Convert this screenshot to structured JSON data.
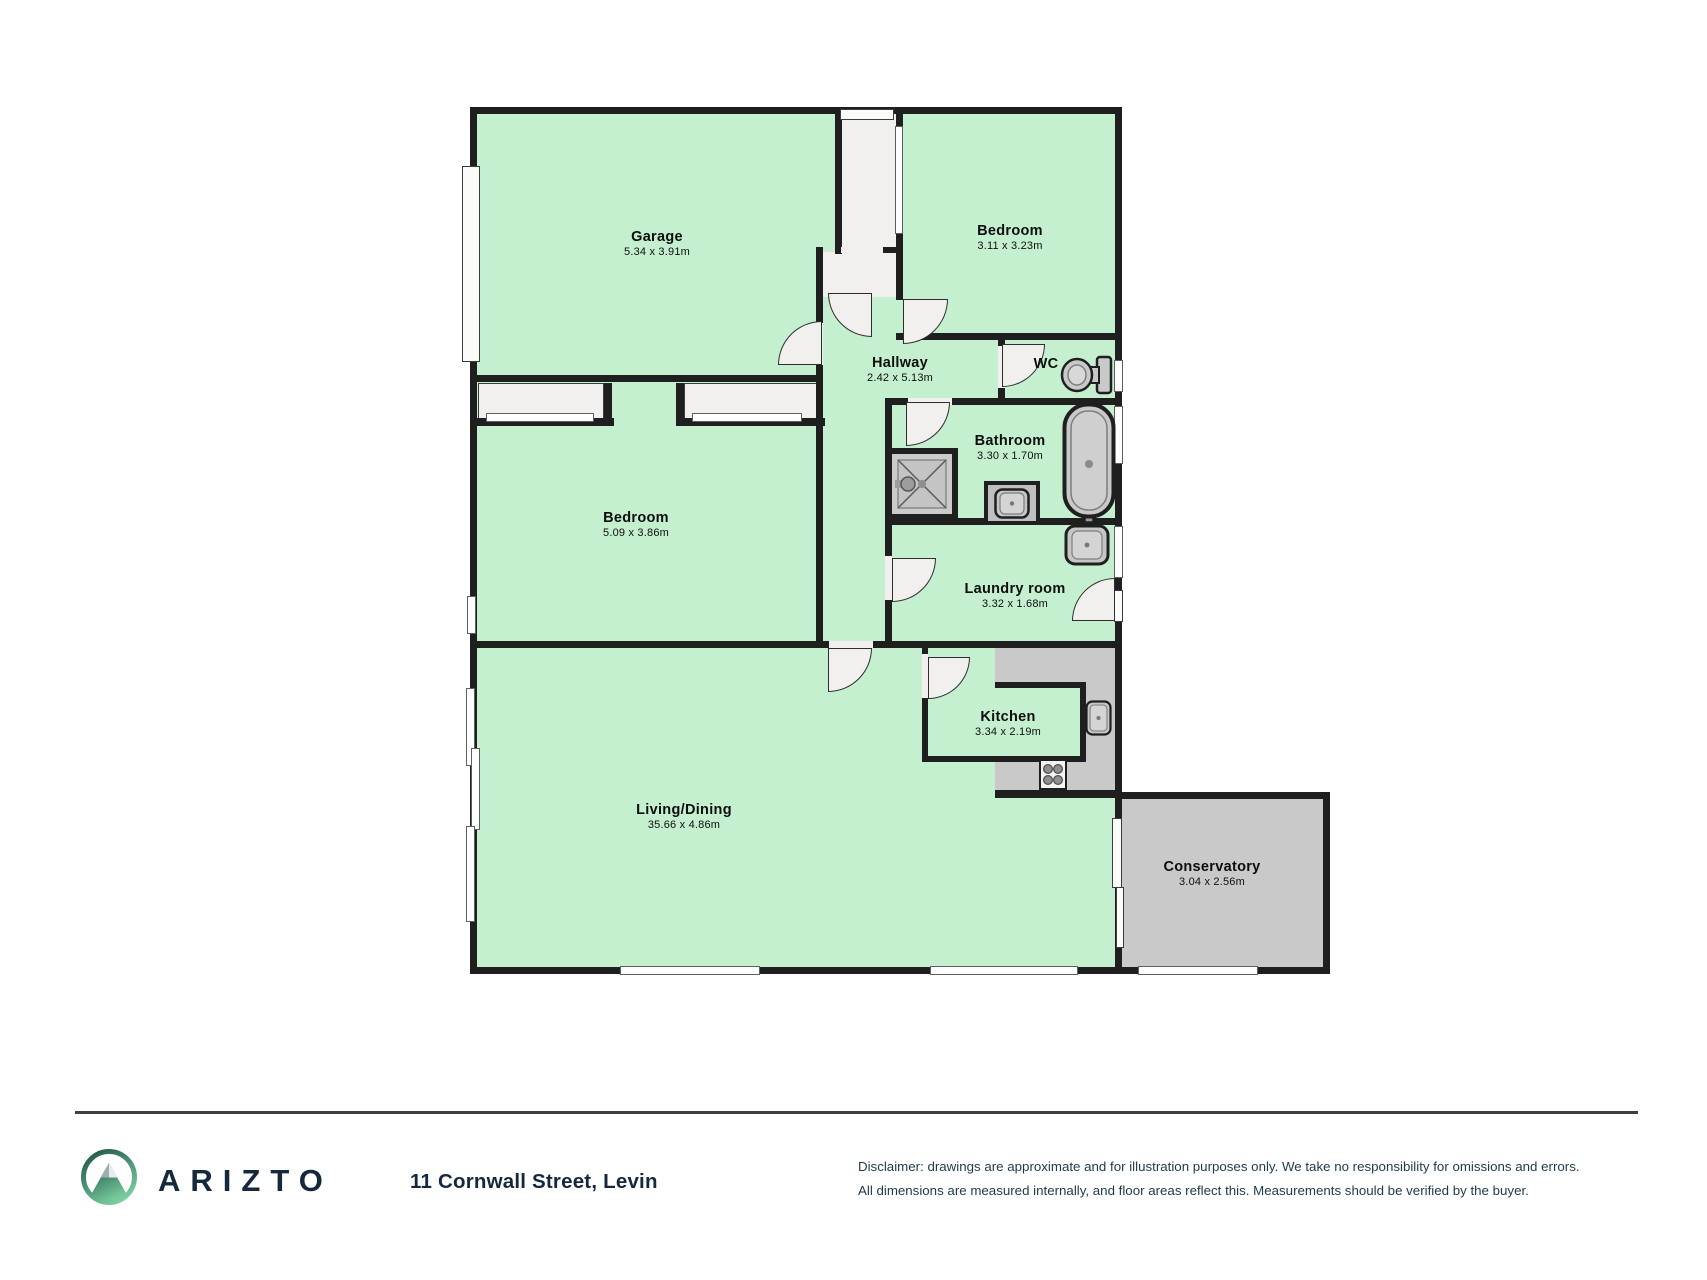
{
  "floorplan": {
    "rooms": [
      {
        "name": "Garage",
        "dims": "5.34 x 3.91m"
      },
      {
        "name": "Bedroom",
        "dims": "3.11 x 3.23m"
      },
      {
        "name": "Hallway",
        "dims": "2.42 x 5.13m"
      },
      {
        "name": "WC",
        "dims": ""
      },
      {
        "name": "Bathroom",
        "dims": "3.30 x 1.70m"
      },
      {
        "name": "Laundry room",
        "dims": "3.32 x 1.68m"
      },
      {
        "name": "Bedroom",
        "dims": "5.09 x 3.86m"
      },
      {
        "name": "Kitchen",
        "dims": "3.34 x 2.19m"
      },
      {
        "name": "Living/Dining",
        "dims": "35.66 x 4.86m"
      },
      {
        "name": "Conservatory",
        "dims": "3.04 x 2.56m"
      }
    ],
    "colors": {
      "wall": "#1f1f1f",
      "room_green": "#c5f0cf",
      "exterior_grey": "#c9c9c9",
      "door_white": "#f1f0ee",
      "brand_navy": "#15283c",
      "logo_dark_green": "#255c50",
      "logo_light_green": "#7dd2a2"
    }
  },
  "footer": {
    "brand": "ARIZTO",
    "address": "11 Cornwall Street, Levin",
    "disclaimer_line1": "Disclaimer: drawings are approximate and for illustration purposes only. We take no responsibility for omissions and errors.",
    "disclaimer_line2": "All dimensions are measured internally, and floor areas reflect this. Measurements should be verified by the buyer."
  }
}
